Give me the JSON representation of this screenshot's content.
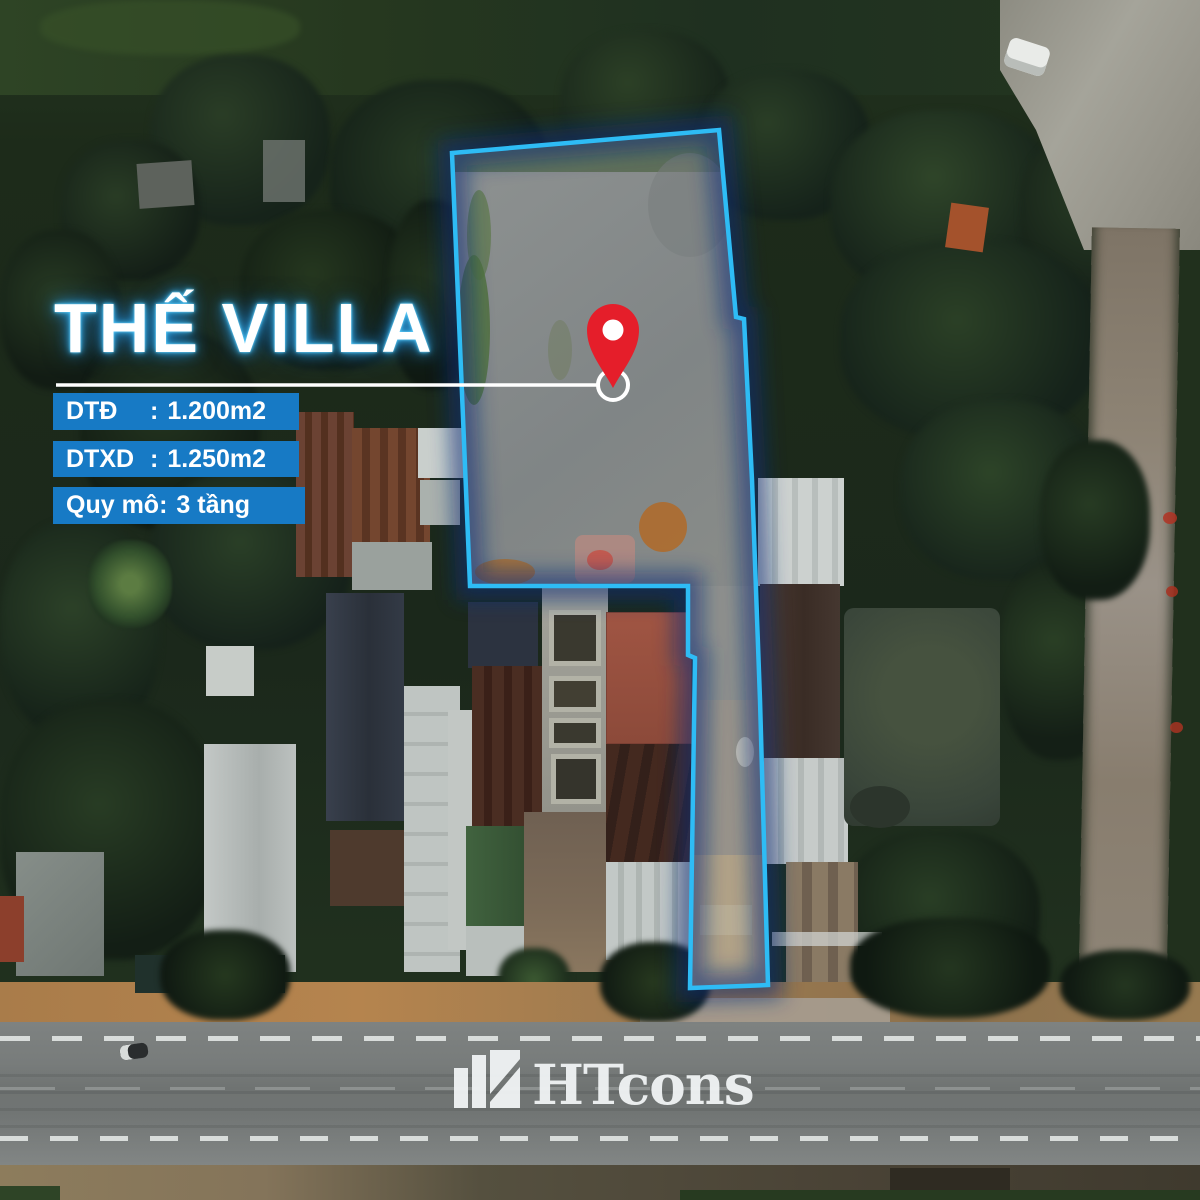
{
  "project": {
    "title": "THẾ VILLA",
    "specs": [
      {
        "label": "DTĐ",
        "separator": ":",
        "value": "1.200m2"
      },
      {
        "label": "DTXD",
        "separator": ":",
        "value": "1.250m2"
      },
      {
        "label": "Quy mô",
        "separator": ":",
        "value": "3 tầng"
      }
    ]
  },
  "brand": {
    "name": "HTcons"
  },
  "icons": {
    "pin": "map-pin-icon",
    "brand_icon": "bar-chart-logo-icon"
  },
  "colors": {
    "badge_blue": "#177ac5",
    "boundary_cyan": "#2ebcf5",
    "boundary_glow_navy": "#0a2f78",
    "pin_red": "#e51e2a",
    "title_glow": "#45c4f7",
    "text_white": "#ffffff"
  }
}
